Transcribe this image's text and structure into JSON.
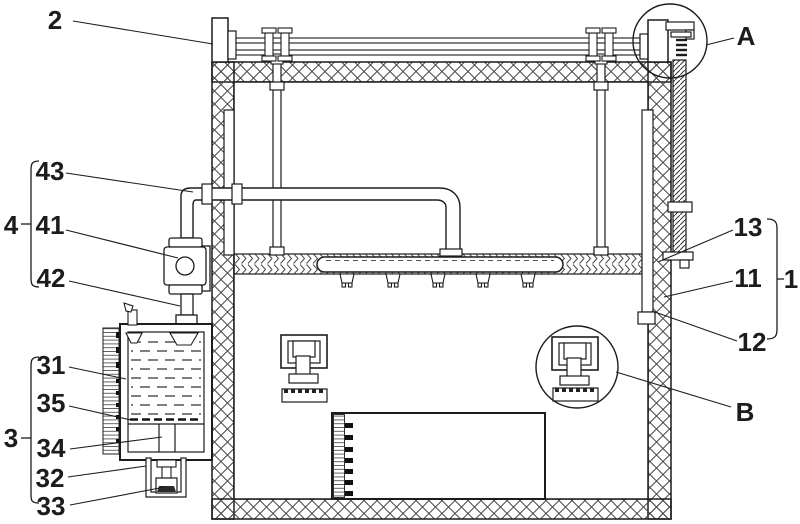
{
  "figure": {
    "type": "patent-line-drawing",
    "colors": {
      "line": "#1c1c1c",
      "background": "#ffffff"
    },
    "labels": {
      "l2": "2",
      "l43": "43",
      "l4": "4",
      "l41": "41",
      "l42": "42",
      "l31": "31",
      "l35": "35",
      "l3": "3",
      "l34": "34",
      "l32": "32",
      "l33": "33",
      "l13": "13",
      "l11": "11",
      "l1": "1",
      "l12": "12",
      "lA": "A",
      "lB": "B"
    }
  }
}
